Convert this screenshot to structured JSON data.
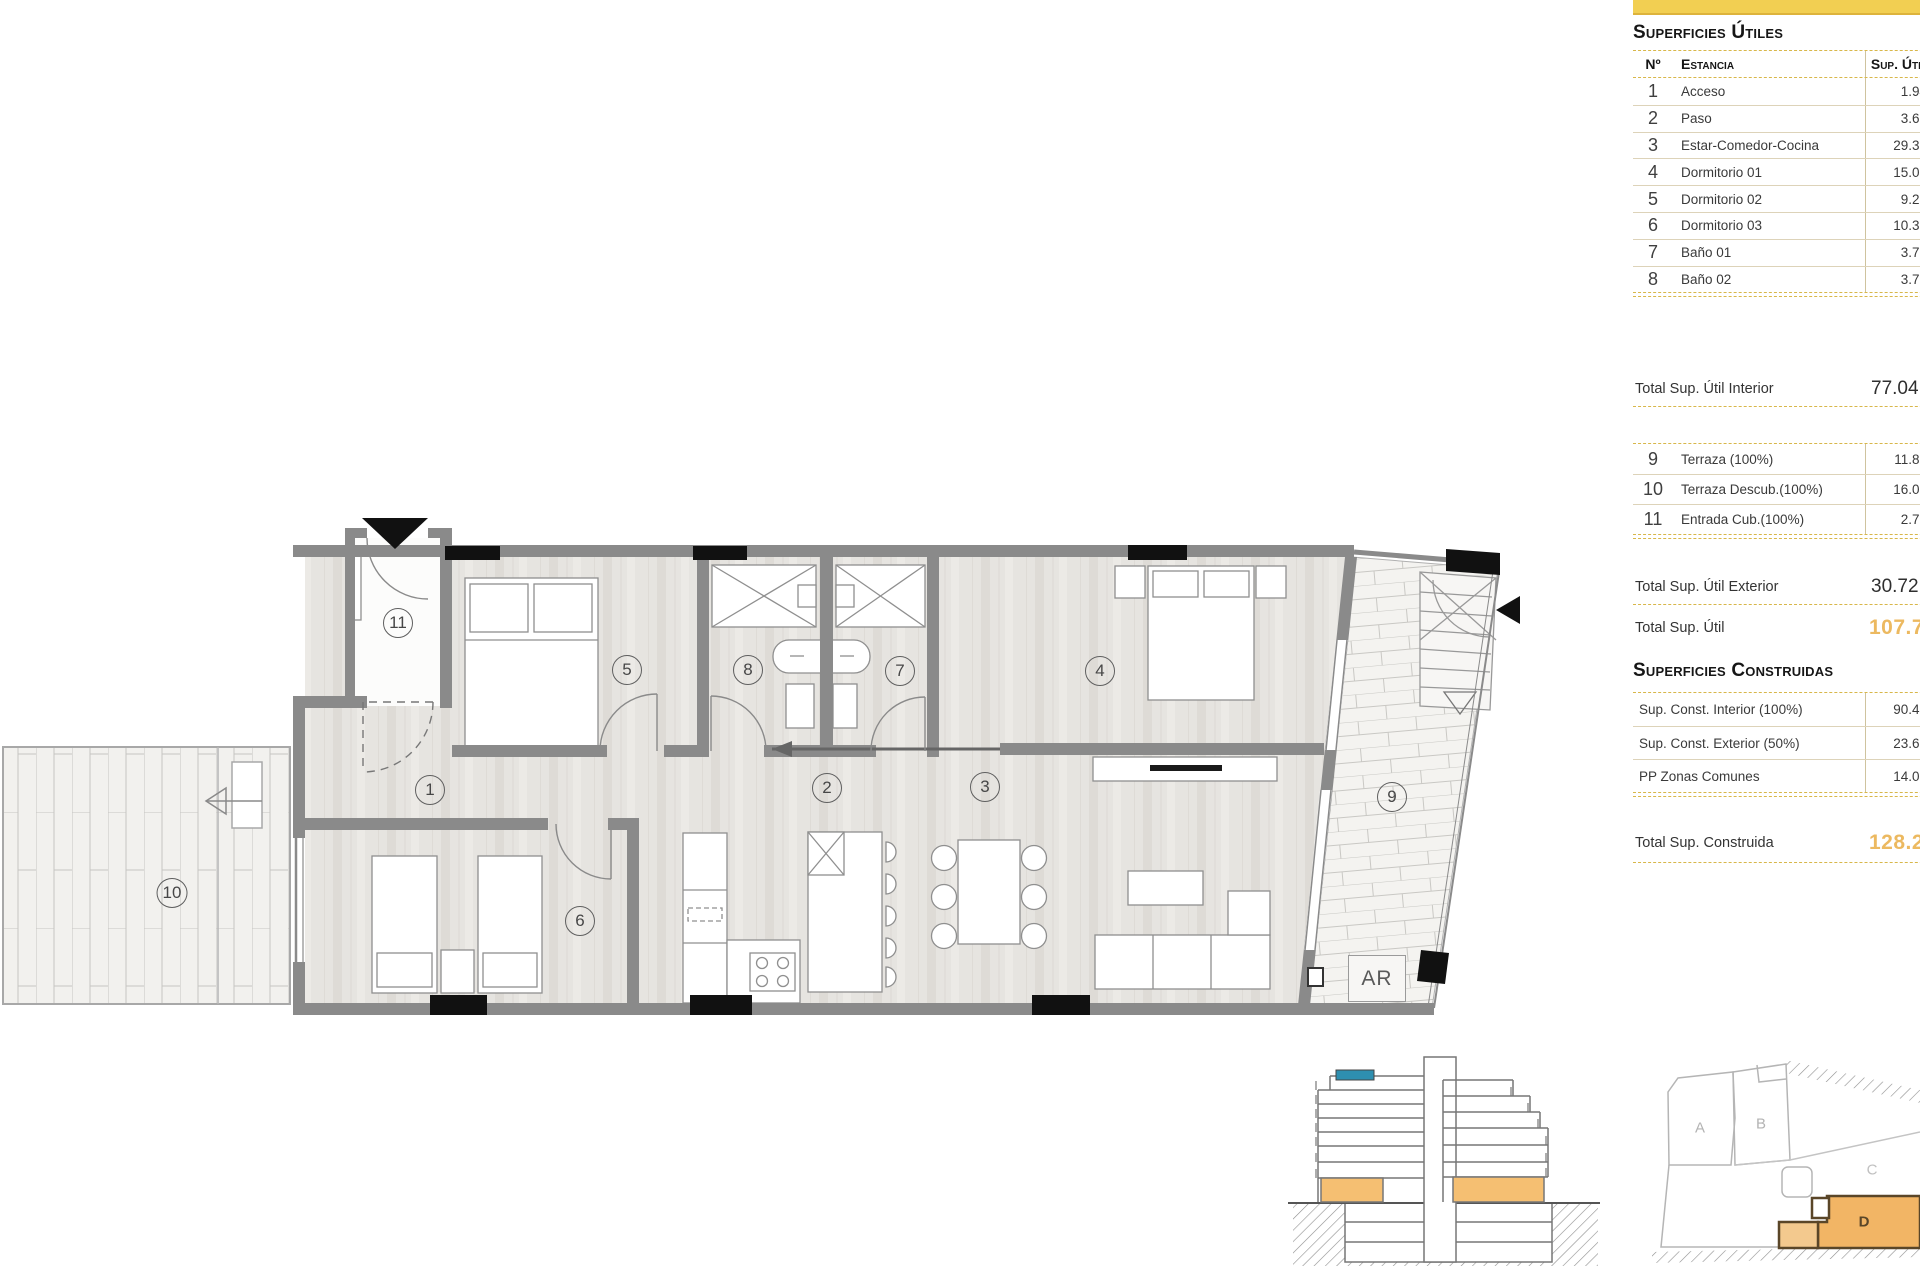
{
  "colors": {
    "accent_yellow": "#f2cf52",
    "accent_yellow_dark": "#ddb33c",
    "table_dash": "#d8b74a",
    "row_line": "#ddd3b9",
    "total_orange": "#ecb960",
    "section_orange": "#f5bf72",
    "section_blue": "#2e8fb0",
    "site_orange": "#f2b565",
    "site_outline_dark": "#5a4628",
    "wall_gray": "#8a8a8a"
  },
  "panel": {
    "superficies_utiles_title": "Superficies Útiles",
    "superficies_construidas_title": "Superficies Construidas",
    "header": {
      "no": "Nº",
      "estancia": "Estancia",
      "sup": "Sup. Útil"
    },
    "utiles_rows": [
      {
        "n": "1",
        "name": "Acceso",
        "value": "1.94"
      },
      {
        "n": "2",
        "name": "Paso",
        "value": "3.67"
      },
      {
        "n": "3",
        "name": "Estar-Comedor-Cocina",
        "value": "29.39"
      },
      {
        "n": "4",
        "name": "Dormitorio 01",
        "value": "15.03"
      },
      {
        "n": "5",
        "name": "Dormitorio 02",
        "value": "9.29"
      },
      {
        "n": "6",
        "name": "Dormitorio 03",
        "value": "10.30"
      },
      {
        "n": "7",
        "name": "Baño 01",
        "value": "3.71"
      },
      {
        "n": "8",
        "name": "Baño 02",
        "value": "3.71"
      }
    ],
    "total_interior": {
      "label": "Total Sup. Útil Interior",
      "value": "77.04"
    },
    "exterior_rows": [
      {
        "n": "9",
        "name": "Terraza (100%)",
        "value": "11.88"
      },
      {
        "n": "10",
        "name": "Terraza Descub.(100%)",
        "value": "16.08"
      },
      {
        "n": "11",
        "name": "Entrada Cub.(100%)",
        "value": "2.76"
      }
    ],
    "total_exterior": {
      "label": "Total Sup. Útil Exterior",
      "value": "30.72"
    },
    "total_util": {
      "label": "Total Sup. Útil",
      "value": "107.7"
    },
    "construidas_rows": [
      {
        "name": "Sup. Const. Interior (100%)",
        "value": "90.48"
      },
      {
        "name": "Sup. Const. Exterior (50%)",
        "value": "23.68"
      },
      {
        "name": "PP Zonas Comunes",
        "value": "14.05"
      }
    ],
    "total_construida": {
      "label": "Total Sup. Construida",
      "value": "128.2"
    }
  },
  "plan": {
    "room_labels": [
      {
        "n": "1",
        "x": 430,
        "y": 790
      },
      {
        "n": "2",
        "x": 827,
        "y": 788
      },
      {
        "n": "3",
        "x": 985,
        "y": 787
      },
      {
        "n": "4",
        "x": 1100,
        "y": 671
      },
      {
        "n": "5",
        "x": 627,
        "y": 670
      },
      {
        "n": "6",
        "x": 580,
        "y": 921
      },
      {
        "n": "7",
        "x": 900,
        "y": 671
      },
      {
        "n": "8",
        "x": 748,
        "y": 670
      },
      {
        "n": "9",
        "x": 1392,
        "y": 797
      },
      {
        "n": "10",
        "x": 172,
        "y": 893
      },
      {
        "n": "11",
        "x": 398,
        "y": 623
      }
    ],
    "ar_label": "AR"
  },
  "site_plan": {
    "labels": [
      {
        "n": "A",
        "x": 1700,
        "y": 1128,
        "color": "#b3b3b3"
      },
      {
        "n": "B",
        "x": 1761,
        "y": 1124,
        "color": "#b3b3b3"
      },
      {
        "n": "C",
        "x": 1872,
        "y": 1170,
        "color": "#c0c0c0"
      },
      {
        "n": "D",
        "x": 1864,
        "y": 1222,
        "color": "#5a4628"
      }
    ]
  }
}
